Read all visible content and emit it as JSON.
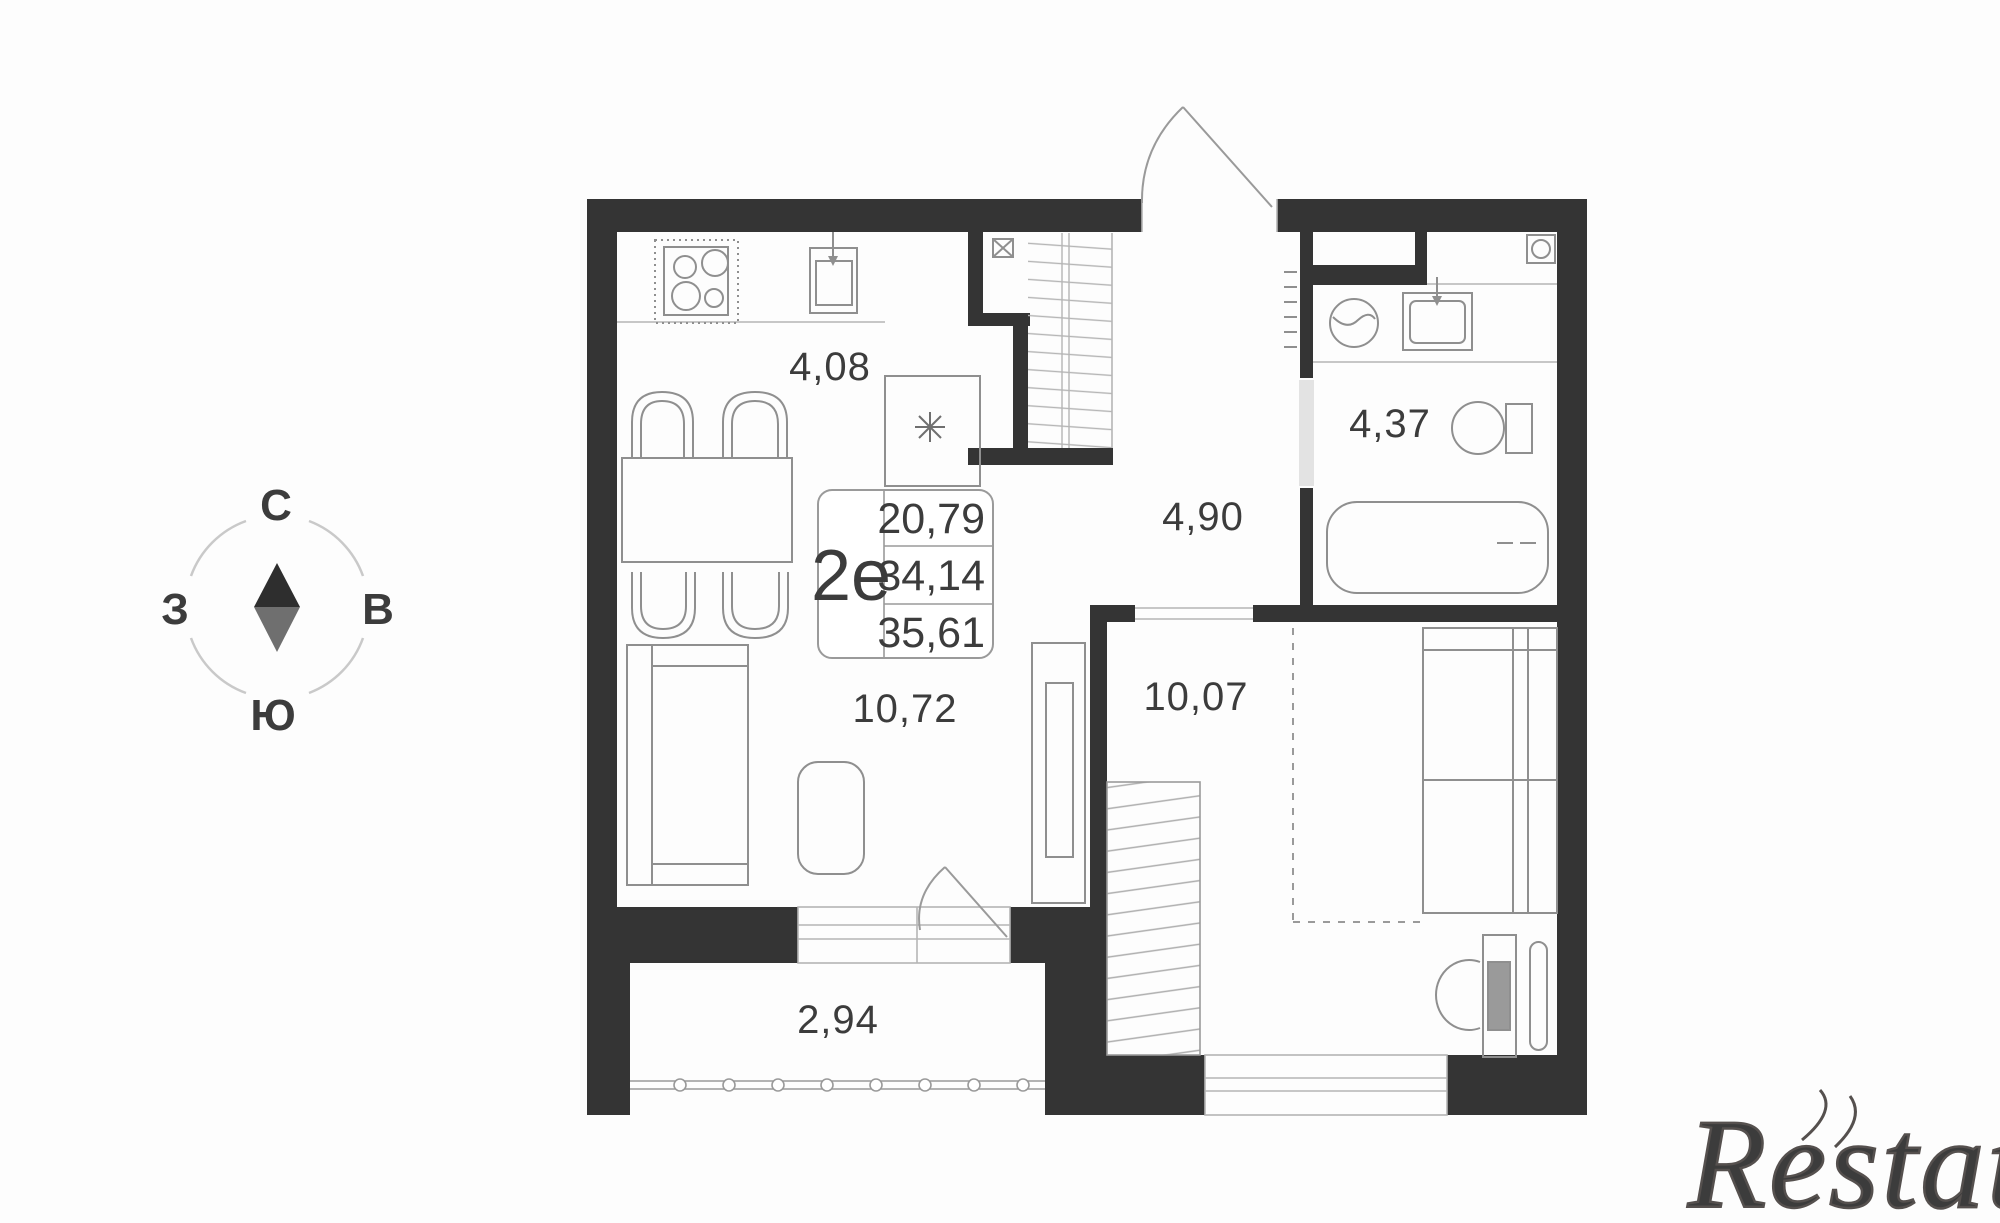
{
  "colors": {
    "wall": "#343434",
    "line": "#8f8f8f",
    "light_line": "#b5b5b5",
    "text": "#3c3c3c",
    "compass_dark": "#2e2e2e",
    "compass_gray": "#6f6f6f",
    "watermark": "#55504e"
  },
  "compass": {
    "north": "С",
    "east": "В",
    "south": "Ю",
    "west": "З"
  },
  "info_box": {
    "unit_type": "2е",
    "line1": "20,79",
    "line2": "34,14",
    "line3": "35,61"
  },
  "areas": {
    "kitchen": "4,08",
    "bathroom": "4,37",
    "hallway": "4,90",
    "living_room": "10,72",
    "bedroom": "10,07",
    "balcony": "2,94"
  },
  "watermark": {
    "text": "Restate"
  }
}
